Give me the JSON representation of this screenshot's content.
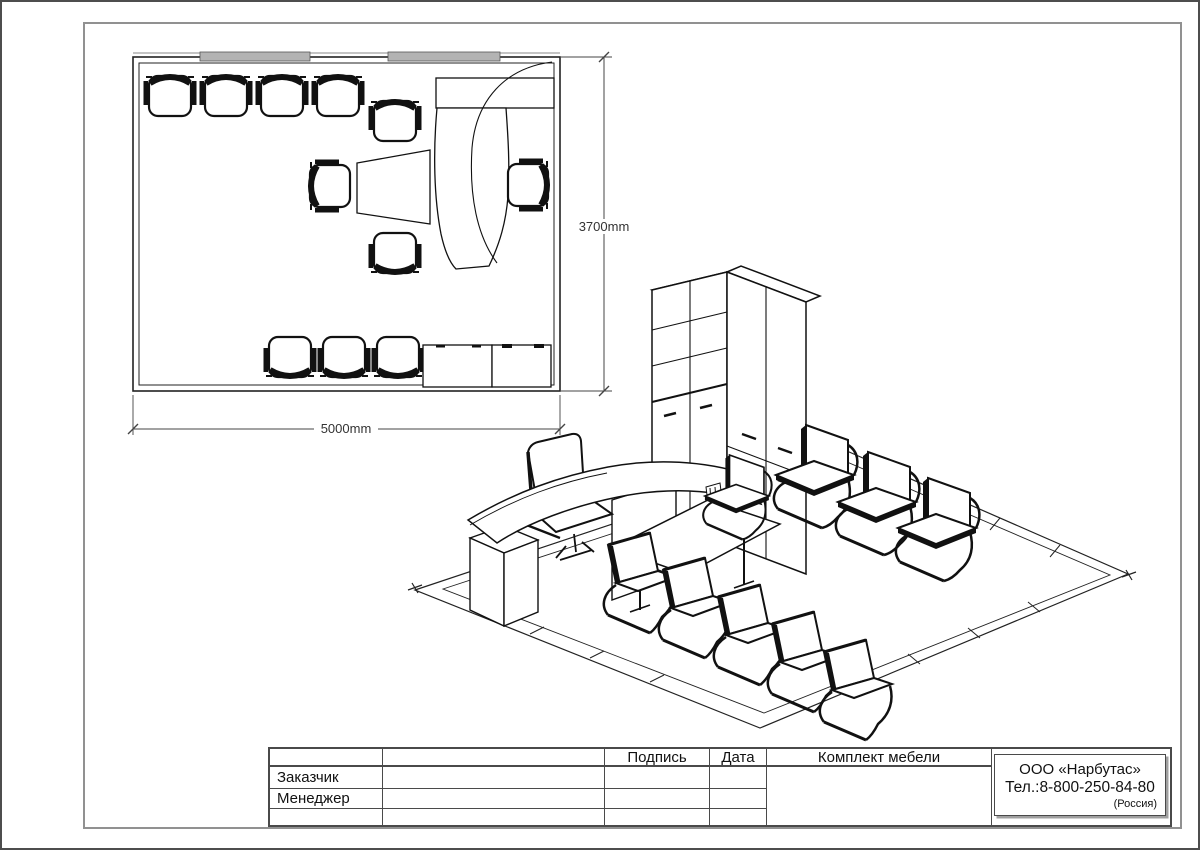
{
  "sheet": {
    "colors": {
      "line": "#1a1a1a",
      "frame": "#919191",
      "window_fill": "#b3b3b3",
      "shadow": "#a0a0a0"
    }
  },
  "floor_plan": {
    "width_label": "5000mm",
    "height_label": "3700mm"
  },
  "title_block": {
    "header": {
      "signature": "Подпись",
      "date": "Дата",
      "set": "Комплект мебели"
    },
    "labels": {
      "customer": "Заказчик",
      "manager": "Менеджер"
    },
    "company": {
      "name": "ООО «Нарбутас»",
      "phone": "Тел.:8-800-250-84-80",
      "country": "(Россия)"
    }
  }
}
